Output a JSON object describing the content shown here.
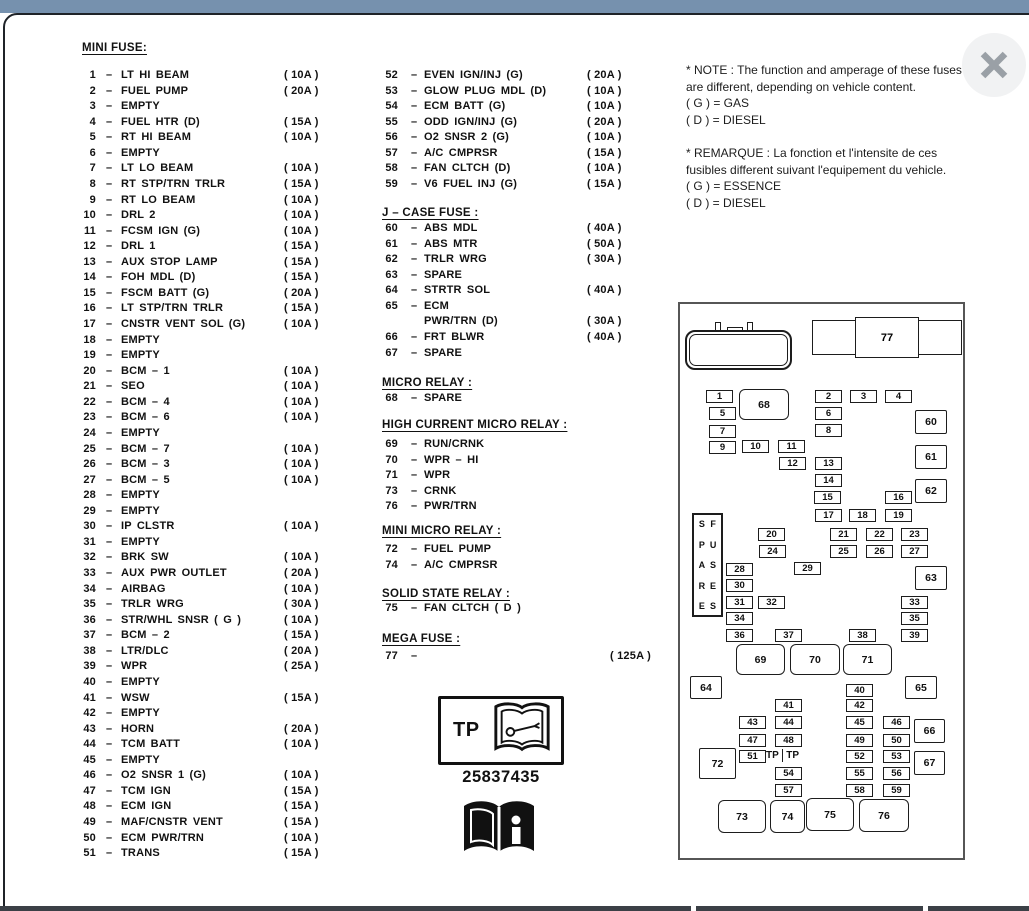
{
  "ui": {
    "dash": "–"
  },
  "mini_fuse": {
    "title": "MINI FUSE:",
    "items": [
      {
        "num": "1",
        "label": "LT HI BEAM",
        "amp": "( 10A )"
      },
      {
        "num": "2",
        "label": "FUEL PUMP",
        "amp": "( 20A )"
      },
      {
        "num": "3",
        "label": "EMPTY",
        "amp": ""
      },
      {
        "num": "4",
        "label": "FUEL HTR  (D)",
        "amp": "( 15A )"
      },
      {
        "num": "5",
        "label": "RT HI BEAM",
        "amp": "( 10A )"
      },
      {
        "num": "6",
        "label": "EMPTY",
        "amp": ""
      },
      {
        "num": "7",
        "label": "LT LO BEAM",
        "amp": "( 10A )"
      },
      {
        "num": "8",
        "label": "RT STP/TRN TRLR",
        "amp": "( 15A )"
      },
      {
        "num": "9",
        "label": "RT LO BEAM",
        "amp": "( 10A )"
      },
      {
        "num": "10",
        "label": "DRL 2",
        "amp": "( 10A )"
      },
      {
        "num": "11",
        "label": "FCSM IGN (G)",
        "amp": "( 10A )"
      },
      {
        "num": "12",
        "label": "DRL 1",
        "amp": "( 15A )"
      },
      {
        "num": "13",
        "label": "AUX STOP LAMP",
        "amp": "( 15A )"
      },
      {
        "num": "14",
        "label": "FOH MDL (D)",
        "amp": "( 15A )"
      },
      {
        "num": "15",
        "label": "FSCM BATT (G)",
        "amp": "( 20A )"
      },
      {
        "num": "16",
        "label": "LT STP/TRN TRLR",
        "amp": "( 15A )"
      },
      {
        "num": "17",
        "label": "CNSTR VENT SOL (G)",
        "amp": "( 10A )"
      },
      {
        "num": "18",
        "label": "EMPTY",
        "amp": ""
      },
      {
        "num": "19",
        "label": "EMPTY",
        "amp": ""
      },
      {
        "num": "20",
        "label": "BCM – 1",
        "amp": "( 10A )"
      },
      {
        "num": "21",
        "label": "SEO",
        "amp": "( 10A )"
      },
      {
        "num": "22",
        "label": "BCM – 4",
        "amp": "( 10A )"
      },
      {
        "num": "23",
        "label": "BCM – 6",
        "amp": "( 10A )"
      },
      {
        "num": "24",
        "label": "EMPTY",
        "amp": ""
      },
      {
        "num": "25",
        "label": "BCM – 7",
        "amp": "( 10A )"
      },
      {
        "num": "26",
        "label": "BCM – 3",
        "amp": "( 10A )"
      },
      {
        "num": "27",
        "label": "BCM – 5",
        "amp": "( 10A )"
      },
      {
        "num": "28",
        "label": "EMPTY",
        "amp": ""
      },
      {
        "num": "29",
        "label": "EMPTY",
        "amp": ""
      },
      {
        "num": "30",
        "label": "IP CLSTR",
        "amp": "( 10A )"
      },
      {
        "num": "31",
        "label": "EMPTY",
        "amp": ""
      },
      {
        "num": "32",
        "label": "BRK SW",
        "amp": "( 10A )"
      },
      {
        "num": "33",
        "label": "AUX PWR OUTLET",
        "amp": "( 20A )"
      },
      {
        "num": "34",
        "label": "AIRBAG",
        "amp": "( 10A )"
      },
      {
        "num": "35",
        "label": "TRLR WRG",
        "amp": "( 30A )"
      },
      {
        "num": "36",
        "label": "STR/WHL SNSR ( G )",
        "amp": "( 10A )"
      },
      {
        "num": "37",
        "label": "BCM – 2",
        "amp": "( 15A )"
      },
      {
        "num": "38",
        "label": "LTR/DLC",
        "amp": "( 20A )"
      },
      {
        "num": "39",
        "label": "WPR",
        "amp": "( 25A )"
      },
      {
        "num": "40",
        "label": "EMPTY",
        "amp": ""
      },
      {
        "num": "41",
        "label": "WSW",
        "amp": "( 15A )"
      },
      {
        "num": "42",
        "label": "EMPTY",
        "amp": ""
      },
      {
        "num": "43",
        "label": "HORN",
        "amp": "( 20A )"
      },
      {
        "num": "44",
        "label": "TCM BATT",
        "amp": "( 10A )"
      },
      {
        "num": "45",
        "label": "EMPTY",
        "amp": ""
      },
      {
        "num": "46",
        "label": "O2 SNSR 1 (G)",
        "amp": "( 10A )"
      },
      {
        "num": "47",
        "label": "TCM IGN",
        "amp": "( 15A )"
      },
      {
        "num": "48",
        "label": "ECM IGN",
        "amp": "( 15A )"
      },
      {
        "num": "49",
        "label": "MAF/CNSTR VENT",
        "amp": "( 15A )"
      },
      {
        "num": "50",
        "label": "ECM PWR/TRN",
        "amp": "( 10A )"
      },
      {
        "num": "51",
        "label": "TRANS",
        "amp": "( 15A )"
      }
    ]
  },
  "col2": {
    "mini_fuse_items": [
      {
        "num": "52",
        "label": "EVEN IGN/INJ (G)",
        "amp": "( 20A )"
      },
      {
        "num": "53",
        "label": "GLOW PLUG MDL (D)",
        "amp": "( 10A )"
      },
      {
        "num": "54",
        "label": "ECM BATT (G)",
        "amp": "( 10A )"
      },
      {
        "num": "55",
        "label": "ODD IGN/INJ (G)",
        "amp": "( 20A )"
      },
      {
        "num": "56",
        "label": "O2 SNSR 2 (G)",
        "amp": "( 10A )"
      },
      {
        "num": "57",
        "label": "A/C CMPRSR",
        "amp": "( 15A )"
      },
      {
        "num": "58",
        "label": "FAN CLTCH (D)",
        "amp": "( 10A )"
      },
      {
        "num": "59",
        "label": "V6 FUEL INJ (G)",
        "amp": "( 15A )"
      }
    ],
    "j_case_title": "J – CASE FUSE :",
    "j_case_items": [
      {
        "num": "60",
        "label": "ABS MDL",
        "amp": "( 40A )"
      },
      {
        "num": "61",
        "label": "ABS MTR",
        "amp": "( 50A )"
      },
      {
        "num": "62",
        "label": "TRLR WRG",
        "amp": "( 30A )"
      },
      {
        "num": "63",
        "label": "SPARE",
        "amp": ""
      },
      {
        "num": "64",
        "label": "STRTR SOL",
        "amp": "( 40A )"
      },
      {
        "num": "65",
        "label": "ECM",
        "amp": ""
      },
      {
        "num": "",
        "label": "PWR/TRN (D)",
        "amp": "( 30A )"
      },
      {
        "num": "66",
        "label": "FRT BLWR",
        "amp": "( 40A )"
      },
      {
        "num": "67",
        "label": "SPARE",
        "amp": ""
      }
    ],
    "micro_title": "MICRO RELAY :",
    "micro_items": [
      {
        "num": "68",
        "label": "SPARE",
        "amp": ""
      }
    ],
    "high_title": "HIGH CURRENT MICRO RELAY :",
    "high_items": [
      {
        "num": "69",
        "label": "RUN/CRNK",
        "amp": ""
      },
      {
        "num": "70",
        "label": "WPR – HI",
        "amp": ""
      },
      {
        "num": "71",
        "label": "WPR",
        "amp": ""
      },
      {
        "num": "73",
        "label": "CRNK",
        "amp": ""
      },
      {
        "num": "76",
        "label": "PWR/TRN",
        "amp": ""
      }
    ],
    "mini_micro_title": "MINI MICRO RELAY :",
    "mini_micro_items": [
      {
        "num": "72",
        "label": "FUEL PUMP",
        "amp": ""
      },
      {
        "num": "74",
        "label": "A/C CMPRSR",
        "amp": ""
      }
    ],
    "solid_title": "SOLID STATE RELAY :",
    "solid_items": [
      {
        "num": "75",
        "label": "FAN CLTCH ( D )",
        "amp": ""
      }
    ],
    "mega_title": "MEGA FUSE :",
    "mega_items": [
      {
        "num": "77",
        "label": "",
        "amp": "( 125A )"
      }
    ]
  },
  "notes": {
    "en_lines": [
      "* NOTE :  The function and amperage of these fuses",
      "are different, depending on vehicle content.",
      "( G ) =  GAS",
      "( D ) =  DIESEL"
    ],
    "fr_lines": [
      "* REMARQUE :  La fonction et l'intensite de ces",
      "fusibles different suivant l'equipement du vehicle.",
      "( G ) =  ESSENCE",
      "( D ) =  DIESEL"
    ]
  },
  "tp_badge": {
    "label": "TP",
    "part_number": "25837435"
  },
  "diagram": {
    "spare_word1": "SPARE",
    "spare_word2": "FUSES",
    "tp_left": "TP",
    "tp_right": "TP",
    "mega_label": "77",
    "boxes": [
      {
        "id": "1",
        "x": 26,
        "y": 86,
        "w": 27,
        "h": 13,
        "t": "s"
      },
      {
        "id": "5",
        "x": 29,
        "y": 103,
        "w": 27,
        "h": 13,
        "t": "s"
      },
      {
        "id": "7",
        "x": 29,
        "y": 121,
        "w": 27,
        "h": 13,
        "t": "s"
      },
      {
        "id": "9",
        "x": 29,
        "y": 137,
        "w": 27,
        "h": 13,
        "t": "s"
      },
      {
        "id": "10",
        "x": 62,
        "y": 136,
        "w": 27,
        "h": 13,
        "t": "s"
      },
      {
        "id": "11",
        "x": 98,
        "y": 136,
        "w": 27,
        "h": 13,
        "t": "s"
      },
      {
        "id": "12",
        "x": 99,
        "y": 153,
        "w": 27,
        "h": 13,
        "t": "s"
      },
      {
        "id": "2",
        "x": 135,
        "y": 86,
        "w": 27,
        "h": 13,
        "t": "s"
      },
      {
        "id": "3",
        "x": 170,
        "y": 86,
        "w": 27,
        "h": 13,
        "t": "s"
      },
      {
        "id": "4",
        "x": 205,
        "y": 86,
        "w": 27,
        "h": 13,
        "t": "s"
      },
      {
        "id": "6",
        "x": 135,
        "y": 103,
        "w": 27,
        "h": 13,
        "t": "s"
      },
      {
        "id": "8",
        "x": 135,
        "y": 120,
        "w": 27,
        "h": 13,
        "t": "s"
      },
      {
        "id": "13",
        "x": 135,
        "y": 153,
        "w": 27,
        "h": 13,
        "t": "s"
      },
      {
        "id": "14",
        "x": 135,
        "y": 170,
        "w": 27,
        "h": 13,
        "t": "s"
      },
      {
        "id": "15",
        "x": 134,
        "y": 187,
        "w": 27,
        "h": 13,
        "t": "s"
      },
      {
        "id": "16",
        "x": 205,
        "y": 187,
        "w": 27,
        "h": 13,
        "t": "s"
      },
      {
        "id": "17",
        "x": 135,
        "y": 205,
        "w": 27,
        "h": 13,
        "t": "s"
      },
      {
        "id": "18",
        "x": 169,
        "y": 205,
        "w": 27,
        "h": 13,
        "t": "s"
      },
      {
        "id": "19",
        "x": 205,
        "y": 205,
        "w": 27,
        "h": 13,
        "t": "s"
      },
      {
        "id": "20",
        "x": 78,
        "y": 224,
        "w": 27,
        "h": 13,
        "t": "s"
      },
      {
        "id": "24",
        "x": 79,
        "y": 241,
        "w": 27,
        "h": 13,
        "t": "s"
      },
      {
        "id": "21",
        "x": 150,
        "y": 224,
        "w": 27,
        "h": 13,
        "t": "s"
      },
      {
        "id": "22",
        "x": 186,
        "y": 224,
        "w": 27,
        "h": 13,
        "t": "s"
      },
      {
        "id": "23",
        "x": 221,
        "y": 224,
        "w": 27,
        "h": 13,
        "t": "s"
      },
      {
        "id": "25",
        "x": 150,
        "y": 241,
        "w": 27,
        "h": 13,
        "t": "s"
      },
      {
        "id": "26",
        "x": 186,
        "y": 241,
        "w": 27,
        "h": 13,
        "t": "s"
      },
      {
        "id": "27",
        "x": 221,
        "y": 241,
        "w": 27,
        "h": 13,
        "t": "s"
      },
      {
        "id": "28",
        "x": 46,
        "y": 259,
        "w": 27,
        "h": 13,
        "t": "s"
      },
      {
        "id": "29",
        "x": 114,
        "y": 258,
        "w": 27,
        "h": 13,
        "t": "s"
      },
      {
        "id": "30",
        "x": 46,
        "y": 275,
        "w": 27,
        "h": 13,
        "t": "s"
      },
      {
        "id": "31",
        "x": 46,
        "y": 292,
        "w": 27,
        "h": 13,
        "t": "s"
      },
      {
        "id": "32",
        "x": 78,
        "y": 292,
        "w": 27,
        "h": 13,
        "t": "s"
      },
      {
        "id": "33",
        "x": 221,
        "y": 292,
        "w": 27,
        "h": 13,
        "t": "s"
      },
      {
        "id": "34",
        "x": 46,
        "y": 308,
        "w": 27,
        "h": 13,
        "t": "s"
      },
      {
        "id": "35",
        "x": 221,
        "y": 308,
        "w": 27,
        "h": 13,
        "t": "s"
      },
      {
        "id": "36",
        "x": 46,
        "y": 325,
        "w": 27,
        "h": 13,
        "t": "s"
      },
      {
        "id": "37",
        "x": 95,
        "y": 325,
        "w": 27,
        "h": 13,
        "t": "s"
      },
      {
        "id": "38",
        "x": 169,
        "y": 325,
        "w": 27,
        "h": 13,
        "t": "s"
      },
      {
        "id": "39",
        "x": 221,
        "y": 325,
        "w": 27,
        "h": 13,
        "t": "s"
      },
      {
        "id": "40",
        "x": 166,
        "y": 380,
        "w": 27,
        "h": 13,
        "t": "s"
      },
      {
        "id": "41",
        "x": 95,
        "y": 395,
        "w": 27,
        "h": 13,
        "t": "s"
      },
      {
        "id": "42",
        "x": 166,
        "y": 395,
        "w": 27,
        "h": 13,
        "t": "s"
      },
      {
        "id": "43",
        "x": 59,
        "y": 412,
        "w": 27,
        "h": 13,
        "t": "s"
      },
      {
        "id": "44",
        "x": 95,
        "y": 412,
        "w": 27,
        "h": 13,
        "t": "s"
      },
      {
        "id": "45",
        "x": 166,
        "y": 412,
        "w": 27,
        "h": 13,
        "t": "s"
      },
      {
        "id": "46",
        "x": 203,
        "y": 412,
        "w": 27,
        "h": 13,
        "t": "s"
      },
      {
        "id": "47",
        "x": 59,
        "y": 430,
        "w": 27,
        "h": 13,
        "t": "s"
      },
      {
        "id": "48",
        "x": 95,
        "y": 430,
        "w": 27,
        "h": 13,
        "t": "s"
      },
      {
        "id": "49",
        "x": 166,
        "y": 430,
        "w": 27,
        "h": 13,
        "t": "s"
      },
      {
        "id": "50",
        "x": 203,
        "y": 430,
        "w": 27,
        "h": 13,
        "t": "s"
      },
      {
        "id": "51",
        "x": 59,
        "y": 446,
        "w": 27,
        "h": 13,
        "t": "s"
      },
      {
        "id": "52",
        "x": 166,
        "y": 446,
        "w": 27,
        "h": 13,
        "t": "s"
      },
      {
        "id": "53",
        "x": 203,
        "y": 446,
        "w": 27,
        "h": 13,
        "t": "s"
      },
      {
        "id": "54",
        "x": 95,
        "y": 463,
        "w": 27,
        "h": 13,
        "t": "s"
      },
      {
        "id": "55",
        "x": 166,
        "y": 463,
        "w": 27,
        "h": 13,
        "t": "s"
      },
      {
        "id": "56",
        "x": 203,
        "y": 463,
        "w": 27,
        "h": 13,
        "t": "s"
      },
      {
        "id": "57",
        "x": 95,
        "y": 480,
        "w": 27,
        "h": 13,
        "t": "s"
      },
      {
        "id": "58",
        "x": 166,
        "y": 480,
        "w": 27,
        "h": 13,
        "t": "s"
      },
      {
        "id": "59",
        "x": 203,
        "y": 480,
        "w": 27,
        "h": 13,
        "t": "s"
      },
      {
        "id": "60",
        "x": 235,
        "y": 106,
        "w": 32,
        "h": 24,
        "t": "m"
      },
      {
        "id": "61",
        "x": 235,
        "y": 141,
        "w": 32,
        "h": 24,
        "t": "m"
      },
      {
        "id": "62",
        "x": 235,
        "y": 175,
        "w": 32,
        "h": 24,
        "t": "m"
      },
      {
        "id": "63",
        "x": 235,
        "y": 262,
        "w": 32,
        "h": 24,
        "t": "m"
      },
      {
        "id": "64",
        "x": 10,
        "y": 372,
        "w": 32,
        "h": 23,
        "t": "m"
      },
      {
        "id": "65",
        "x": 225,
        "y": 372,
        "w": 32,
        "h": 23,
        "t": "m"
      },
      {
        "id": "66",
        "x": 234,
        "y": 415,
        "w": 31,
        "h": 24,
        "t": "m"
      },
      {
        "id": "67",
        "x": 234,
        "y": 447,
        "w": 31,
        "h": 24,
        "t": "m"
      },
      {
        "id": "72",
        "x": 19,
        "y": 444,
        "w": 37,
        "h": 31,
        "t": "m"
      },
      {
        "id": "68",
        "x": 59,
        "y": 85,
        "w": 50,
        "h": 31,
        "t": "r"
      },
      {
        "id": "69",
        "x": 56,
        "y": 340,
        "w": 49,
        "h": 31,
        "t": "r"
      },
      {
        "id": "70",
        "x": 110,
        "y": 340,
        "w": 50,
        "h": 31,
        "t": "r"
      },
      {
        "id": "71",
        "x": 163,
        "y": 340,
        "w": 49,
        "h": 31,
        "t": "r"
      },
      {
        "id": "73",
        "x": 38,
        "y": 496,
        "w": 48,
        "h": 33,
        "t": "r"
      },
      {
        "id": "74",
        "x": 90,
        "y": 496,
        "w": 35,
        "h": 33,
        "t": "r"
      },
      {
        "id": "75",
        "x": 126,
        "y": 494,
        "w": 48,
        "h": 33,
        "t": "r"
      },
      {
        "id": "76",
        "x": 179,
        "y": 495,
        "w": 50,
        "h": 33,
        "t": "r"
      }
    ]
  }
}
